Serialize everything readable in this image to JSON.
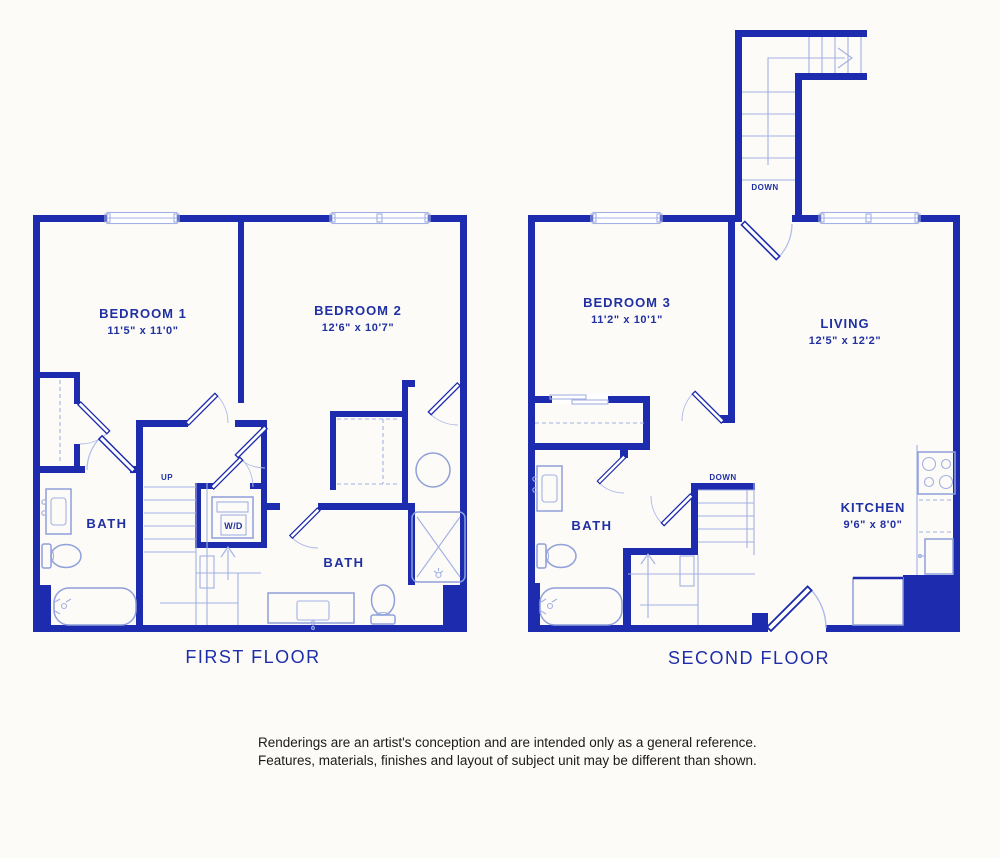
{
  "palette": {
    "wall_blue": "#1d2bae",
    "fixture_light_blue": "#8fa0da",
    "label_blue": "#2030a2",
    "disclaimer_color": "#1a1a1a",
    "background": "#fcfbf7"
  },
  "first_floor": {
    "title": "FIRST FLOOR",
    "rooms": {
      "bedroom1": {
        "name": "BEDROOM 1",
        "dims": "11'5\" x 11'0\""
      },
      "bedroom2": {
        "name": "BEDROOM 2",
        "dims": "12'6\" x 10'7\""
      },
      "bath1": {
        "name": "BATH"
      },
      "bath2": {
        "name": "BATH"
      }
    },
    "labels": {
      "up": "UP",
      "washer_dryer": "W/D"
    }
  },
  "second_floor": {
    "title": "SECOND FLOOR",
    "rooms": {
      "bedroom3": {
        "name": "BEDROOM 3",
        "dims": "11'2\" x 10'1\""
      },
      "living": {
        "name": "LIVING",
        "dims": "12'5\" x 12'2\""
      },
      "kitchen": {
        "name": "KITCHEN",
        "dims": "9'6\" x 8'0\""
      },
      "bath": {
        "name": "BATH"
      }
    },
    "labels": {
      "down_stairwell": "DOWN",
      "down_interior": "DOWN"
    }
  },
  "disclaimer": {
    "line1": "Renderings are an artist's conception and are intended only as a general reference.",
    "line2": "Features, materials, finishes and layout of subject unit may be different than shown."
  }
}
